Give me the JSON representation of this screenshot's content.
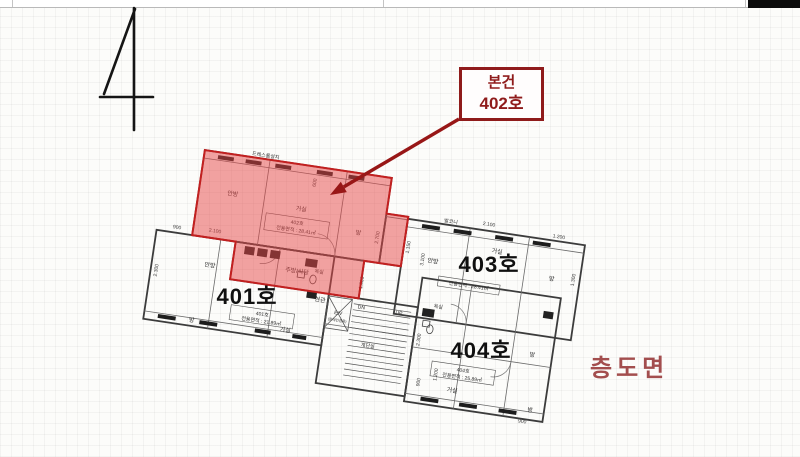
{
  "floor_indicator": {
    "number": "4"
  },
  "callout": {
    "line1": "본건",
    "line2": "402호"
  },
  "caption": {
    "text": "층도면"
  },
  "units": {
    "u401": {
      "label": "401호",
      "area_line1": "401호",
      "area_line2": "전용면적 : 21.89㎡"
    },
    "u402": {
      "area_line1": "402호",
      "area_line2": "전용면적 : 28.41㎡"
    },
    "u403": {
      "label": "403호",
      "area_line2": "전용면적 : 28.41㎡"
    },
    "u404": {
      "label": "404호",
      "area_line1": "404호",
      "area_line2": "전용면적 : 25.89㎡"
    }
  },
  "rooms": {
    "r402_dress": "드레스룸설치",
    "r402_anbang": "안방",
    "r402_geosil": "거실",
    "r402_bang": "방",
    "r402_kitchen": "주방/식당",
    "r403_anbang": "안방",
    "r403_geosil": "거실",
    "r403_bang": "방",
    "r403_balcony": "발코니",
    "r401_anbang": "안방",
    "r401_bang": "방",
    "r401_geosil": "거실",
    "r401_hyungwan": "현관",
    "r401_bath": "욕실",
    "r404_geosil": "거실",
    "r404_bang1": "방",
    "r404_bang2": "방",
    "r404_bath": "욕실",
    "core_stair": "계단실",
    "core_up": "UP",
    "core_dn": "DN",
    "core_ev": "E/V",
    "core_ev_sub": "(장애인겸용)"
  },
  "dims": {
    "d1": "900",
    "d2": "2.100",
    "d3": "2.300",
    "d4": "600",
    "d5": "2.700",
    "d6": "1.600",
    "d7": "2.100",
    "d8": "1.200",
    "d9": "3.100",
    "d10": "1.150",
    "d11": "1.300",
    "d12": "2.300",
    "d13": "1.200",
    "d14": "900",
    "d15": "900"
  },
  "colors": {
    "highlight_fill": "#e64545",
    "highlight_stroke": "#c22020",
    "callout_red": "#8f1b1b",
    "arrow_red": "#981717",
    "caption_red": "#a34e4e",
    "line_dark": "#3c3c3c"
  }
}
